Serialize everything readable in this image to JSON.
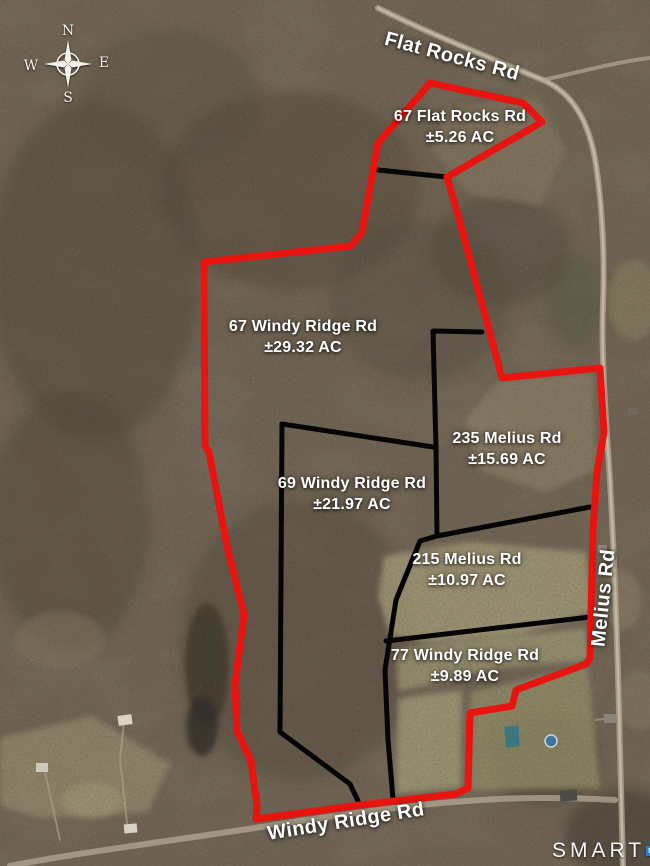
{
  "map": {
    "compass": {
      "n": "N",
      "e": "E",
      "s": "S",
      "w": "W"
    },
    "roads": [
      {
        "id": "flat-rocks",
        "label": "Flat Rocks Rd"
      },
      {
        "id": "melius",
        "label": "Melius Rd"
      },
      {
        "id": "windy-ridge",
        "label": "Windy Ridge Rd"
      }
    ],
    "parcels": [
      {
        "id": "67-flat-rocks",
        "address": "67 Flat Rocks Rd",
        "acreage": "±5.26 AC"
      },
      {
        "id": "67-windy-ridge",
        "address": "67 Windy Ridge Rd",
        "acreage": "±29.32 AC"
      },
      {
        "id": "235-melius",
        "address": "235 Melius Rd",
        "acreage": "±15.69 AC"
      },
      {
        "id": "69-windy-ridge",
        "address": "69 Windy Ridge Rd",
        "acreage": "±21.97 AC"
      },
      {
        "id": "215-melius",
        "address": "215 Melius Rd",
        "acreage": "±10.97 AC"
      },
      {
        "id": "77-windy-ridge",
        "address": "77 Windy Ridge Rd",
        "acreage": "±9.89 AC"
      }
    ],
    "logo": {
      "text": "SMART",
      "mls": [
        "M",
        "L",
        "S"
      ]
    },
    "colors": {
      "outer_boundary": "#e81410",
      "inner_boundary": "#050505",
      "label_text": "#ffffff",
      "logo_blue": "#2d7dc2"
    }
  }
}
